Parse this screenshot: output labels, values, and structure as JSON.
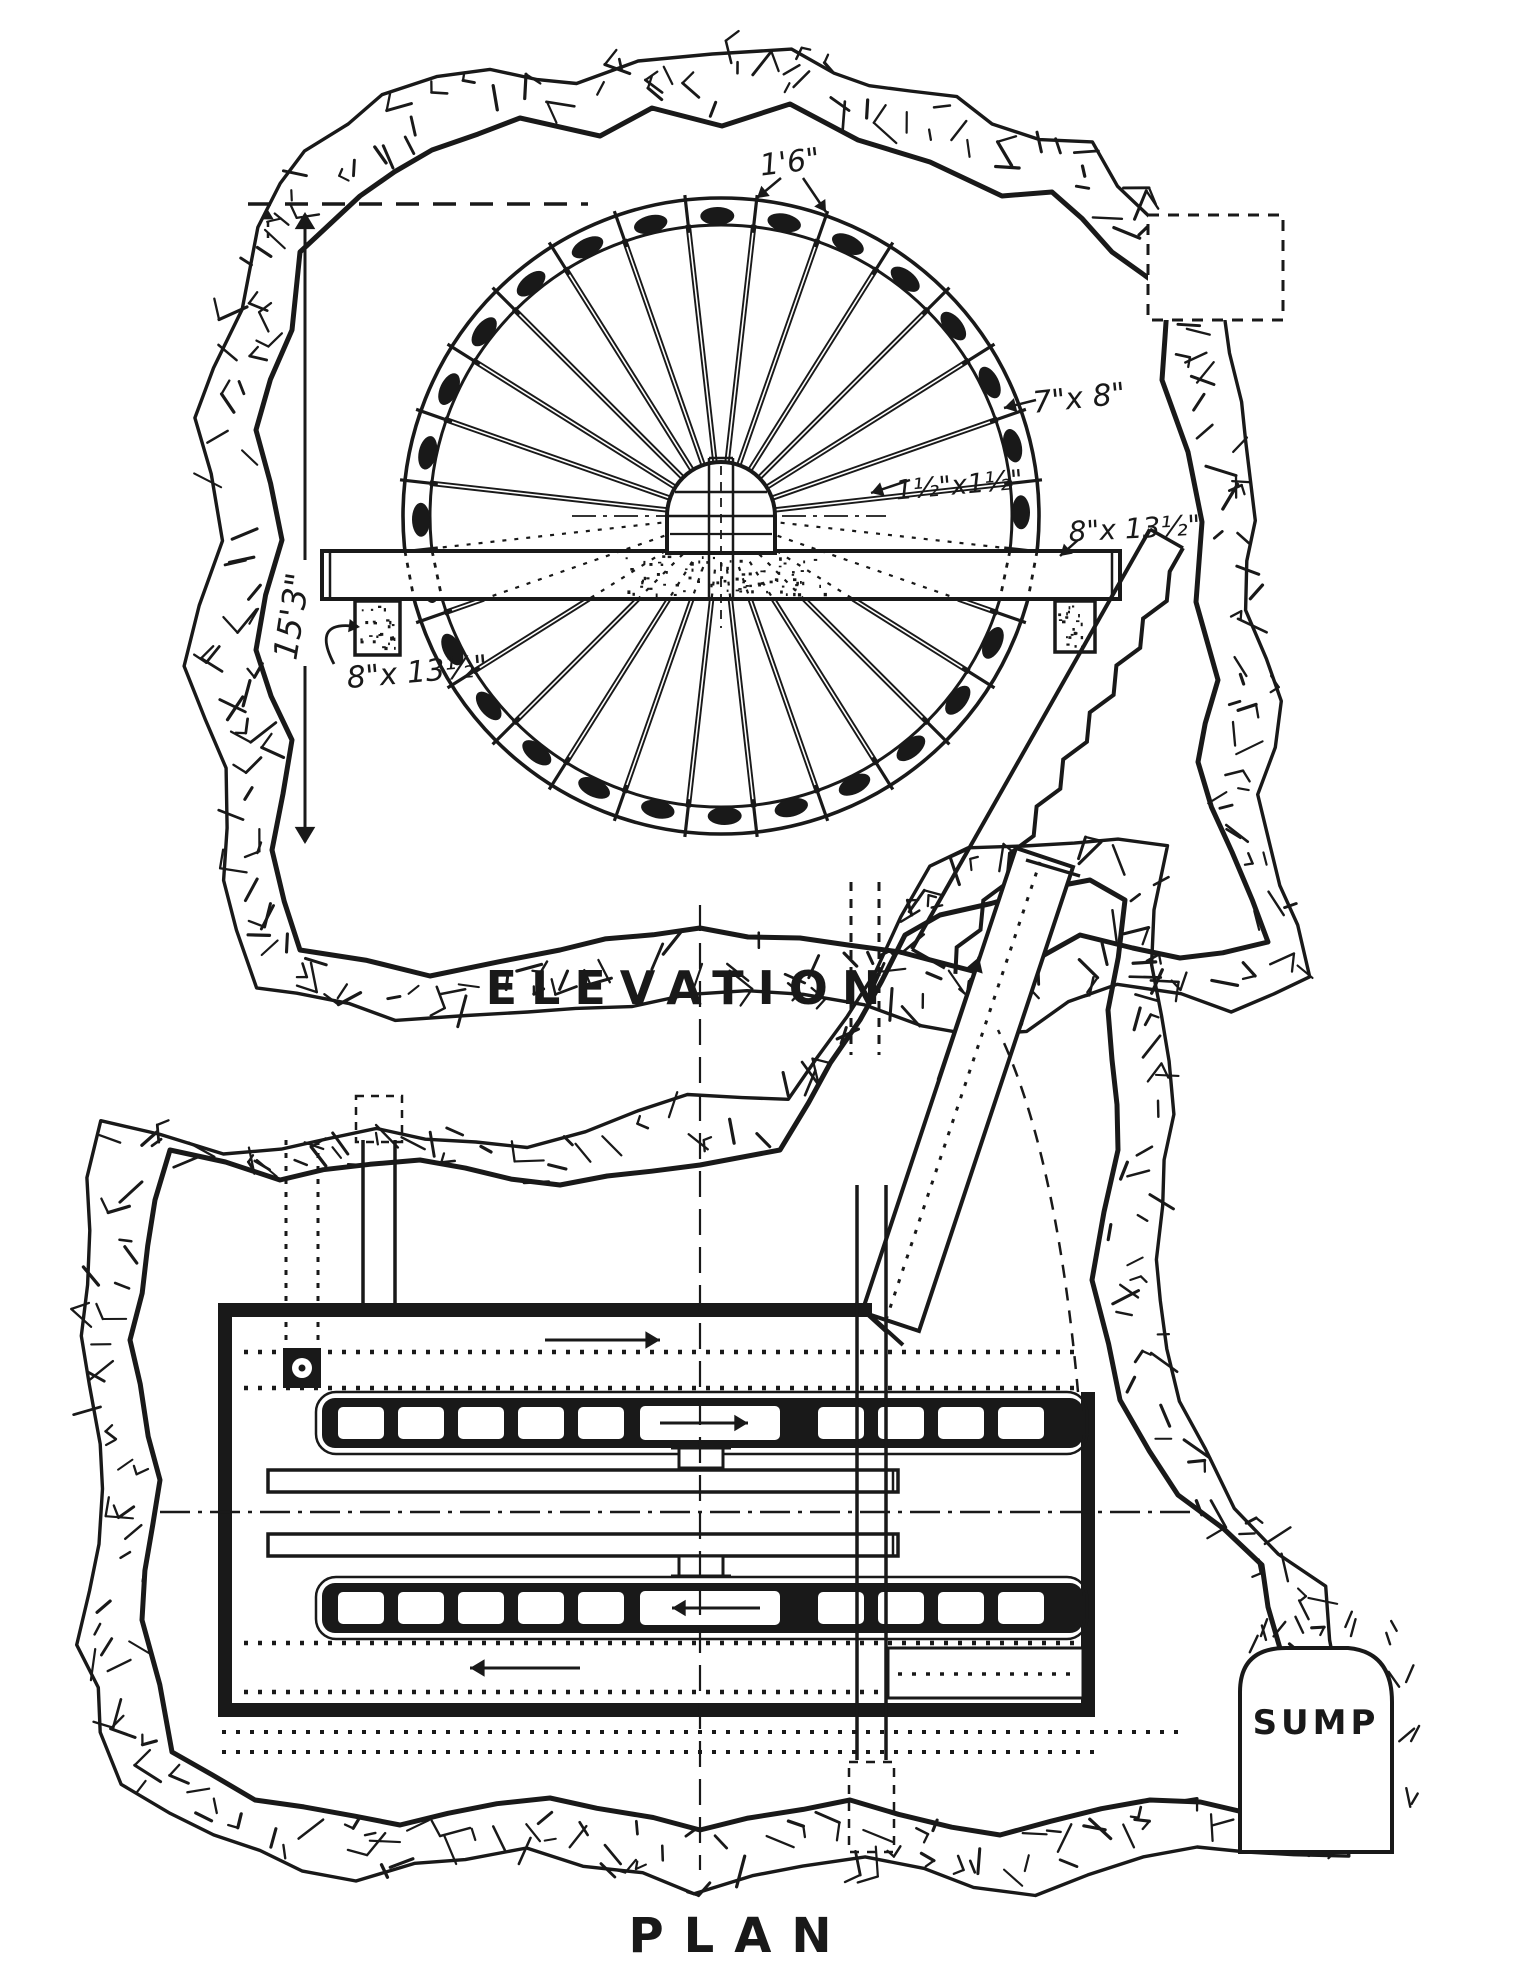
{
  "elevation": {
    "title": "ELEVATION",
    "dimensions": {
      "bucket_pitch": "1'6\"",
      "rim_section": "7\"x 8\"",
      "spoke_section": "1½\"x1½\"",
      "beam_section_right": "8\"x 13½\"",
      "beam_section_left": "8\"x 13½\"",
      "overall_height": "15'3\""
    }
  },
  "plan": {
    "title": "PLAN",
    "sump_label": "SUMP"
  },
  "style": {
    "ink": "#191919",
    "paper": "#ffffff"
  }
}
